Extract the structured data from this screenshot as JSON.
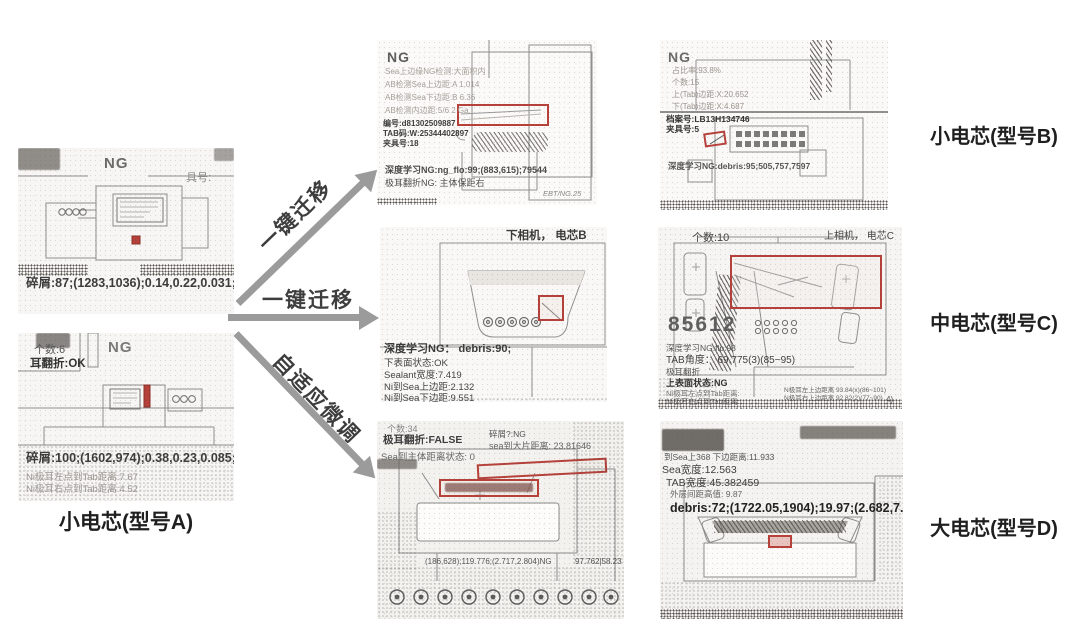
{
  "figure": {
    "source_label": "小电芯(型号A)",
    "target_label_b": "小电芯(型号B)",
    "target_label_c": "中电芯(型号C)",
    "target_label_d": "大电芯(型号D)",
    "arrow_top": "一键迁移",
    "arrow_middle": "一键迁移",
    "arrow_bottom": "自适应微调"
  },
  "colors": {
    "annotation_red": "#b5413a",
    "arrow_gray": "#9b9b9b"
  },
  "panel_a1": {
    "ng": "NG",
    "jig": "具号:",
    "result": "碎屑:87;(1283,1036);0.14,0.22,0.031;"
  },
  "panel_a2": {
    "ng": "NG",
    "count": "个数:6",
    "fold": "耳翻折:OK",
    "result": "碎屑:100;(1602,974);0.38,0.23,0.085;",
    "faint_1": "Ni极耳左点到Tab距离:7.67",
    "faint_2": "Ni极耳右点到Tab距离:4.52"
  },
  "panel_b_mid": {
    "ng": "NG",
    "faint_lines": [
      "Sea上边缘NG检测:大面积内",
      "AB检测Sea上边距:A 1.014",
      "AB检测Sea下边距:B 6.36",
      "AB检测内边距:5/6 2 Ga"
    ],
    "bold_lines": [
      "编号:d81302509887",
      "TAB码:W:25344402897",
      "夹具号:18"
    ],
    "dl": "深度学习NG:ng_flo:99;(883,615);79544",
    "fold": "极耳翻折NG: 主体保距右",
    "corner": "EBT/NG.25"
  },
  "panel_b_right": {
    "ng": "NG",
    "faint_lines": [
      "占比率:93.8%",
      "个数:15",
      "上(Tab)边距:X:20.652",
      "下(Tab)边距:X:4.687"
    ],
    "bold_lines": [
      "档案号:LB13H134746",
      "夹具号:5"
    ],
    "dl": "深度学习NG:debris:95;505,757,7597"
  },
  "panel_c_mid": {
    "header": "下相机， 电芯B",
    "dl": "深度学习NG： debris:90;",
    "lines": [
      "下表面状态:OK",
      "Sealant宽度:7.419",
      "Ni到Sea上边距:2.132",
      "Ni到Sea下边距:9.551"
    ]
  },
  "panel_c_right": {
    "count": "个数:10",
    "header": "上相机， 电芯C",
    "big_number": "85612",
    "lines": [
      "深度学习NG:flp:98",
      "TAB角度： 69.775(3)(85~95)",
      "极耳翻折",
      "上表面状态:NG",
      "Ni极耳左点到Tab距离:",
      "Ni极耳右点到Tab距离:"
    ],
    "side_lines": [
      "N极耳左上边距离 93.84(x)(86~101)",
      "N极耳右上边距离 92.82(2)(77~90)"
    ],
    "corner": "4)"
  },
  "panel_d_mid": {
    "count": "个数:34",
    "fold": "极耳翻折:FALSE",
    "debris_flag": "碎屑?:NG",
    "sea_line": "sea到大片距离: 23.81646",
    "sea_state": "Sea到主体距离状态: 0",
    "mid_values": "(186,628);119.776;(2.717,2.804)NG",
    "right_values": "97.762|58.23"
  },
  "panel_d_right": {
    "lines": [
      "到Sea上368 下边距离:11.933",
      "Sea宽度:12.563",
      "TAB宽度:45.382459",
      "外层间距高值: 9.87"
    ],
    "debris": "debris:72;(1722.05,1904);19.97;(2.682,7.446)"
  }
}
